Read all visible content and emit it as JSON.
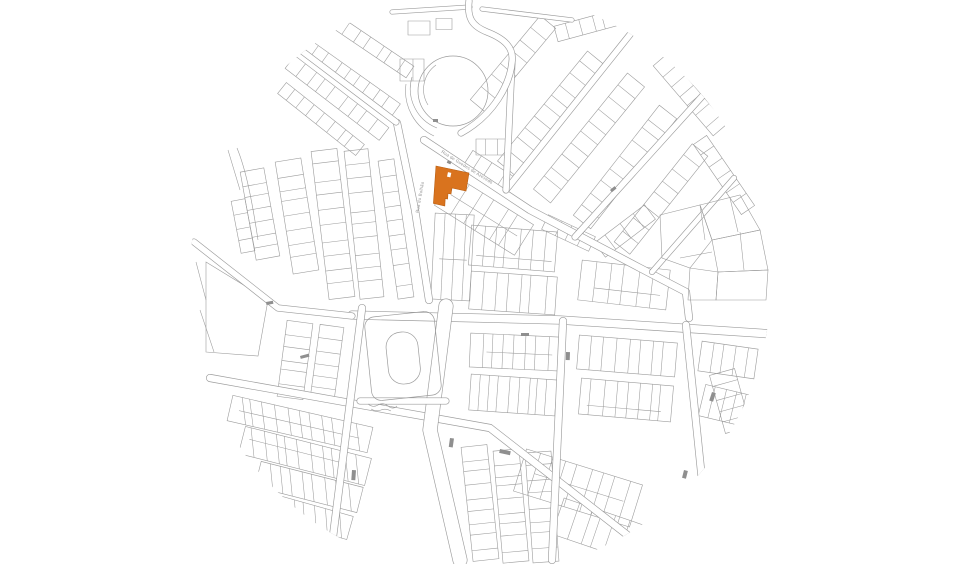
{
  "map": {
    "street_labels": [
      {
        "text": "Rua de Guedes de Azevedo"
      },
      {
        "text": "Rua do Bolhão"
      }
    ],
    "highlight_color": "#D9731E",
    "highlight_edge_color": "#B85E12",
    "line_color": "#9C9C9C",
    "dark_mark_color": "#8F8F8F",
    "label_color": "#8E8E8E",
    "background_color": "#FFFFFF"
  }
}
